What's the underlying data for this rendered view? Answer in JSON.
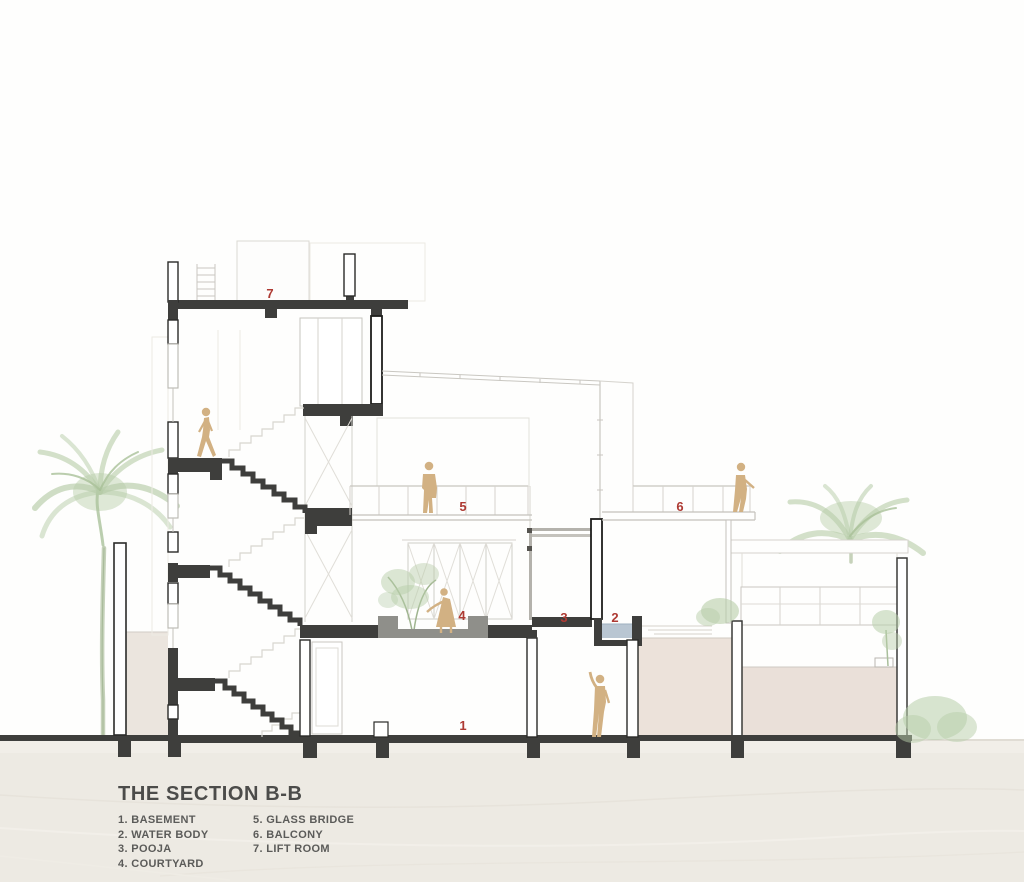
{
  "drawing": {
    "title": "THE SECTION B-B",
    "legend": {
      "col1": [
        "1. BASEMENT",
        "2. WATER BODY",
        "3. POOJA",
        "4. COURTYARD"
      ],
      "col2": [
        "5. GLASS BRIDGE",
        "6. BALCONY",
        "7. LIFT ROOM"
      ]
    }
  },
  "markers": {
    "basement": "1",
    "water_body": "2",
    "pooja": "3",
    "courtyard": "4",
    "glass_bridge": "5",
    "balcony": "6",
    "lift_room": "7"
  },
  "figures": [
    "walking-person-on-stairs",
    "standing-person-on-glass-bridge",
    "gardening-person-in-courtyard",
    "waving-person-in-basement",
    "standing-person-on-balcony",
    "left-palm-tree",
    "right-palm-tree",
    "courtyard-tree",
    "shrubs"
  ],
  "palette": {
    "cut_wall": "#3e3e3c",
    "light_line": "#c9c7c1",
    "accent_red": "#ae3a33",
    "people_tan": "#d2b183",
    "tree_green": "#b7cda9",
    "water_blue": "#b9c6d2",
    "sand": "#edeae3",
    "terrain_fill": "#eae0d9",
    "text_gray": "#4c4c4a"
  }
}
